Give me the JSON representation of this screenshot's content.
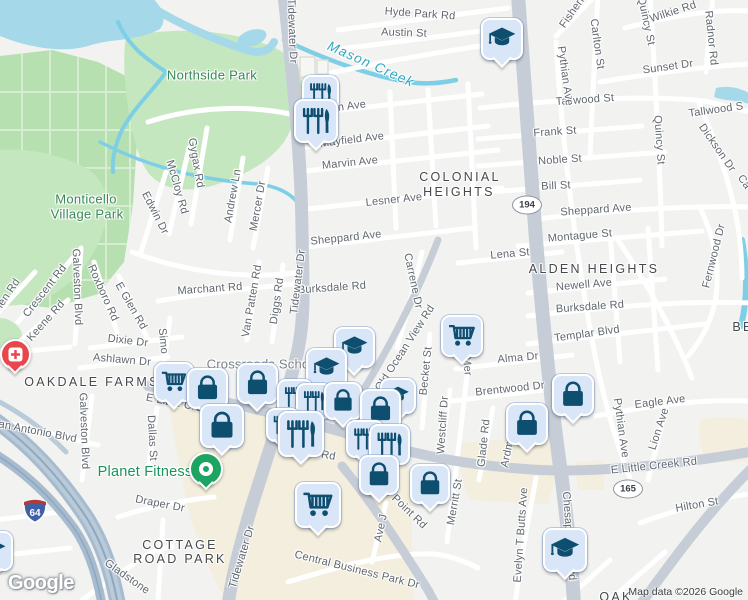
{
  "map": {
    "logo": "Google",
    "attribution": "Map data ©2026 Google",
    "colors": {
      "background": "#f2f2f0",
      "water": "#a5d9ea",
      "creek": "#7ecfe5",
      "park": "#c5e7c0",
      "cemetery": "#b7e0b0",
      "commercial": "#f3eedd",
      "major_road": "#c6cdd7",
      "highway": "#a6bbce",
      "minor_road": "#ffffff",
      "marker_fill": "#d9e6f8",
      "marker_icon": "#0e4e6f",
      "hospital_red": "#e9474b",
      "gym_green": "#1da462",
      "park_label": "#398758",
      "water_label": "#2ea6c0",
      "poi_green": "#18955c"
    },
    "shields": {
      "oval": [
        {
          "label": "194",
          "x": 527,
          "y": 205
        },
        {
          "label": "165",
          "x": 628,
          "y": 489
        }
      ],
      "interstate": {
        "label": "64"
      }
    },
    "labels": [
      {
        "text": "Hyde Park Rd",
        "x": 420,
        "y": 14,
        "rot": 4
      },
      {
        "text": "Austin St",
        "x": 404,
        "y": 33,
        "rot": 2
      },
      {
        "text": "Tidewater Dr",
        "x": 292,
        "y": 31,
        "rot": 88
      },
      {
        "text": "n Ave",
        "x": 352,
        "y": 106,
        "rot": -7
      },
      {
        "text": "Mayfield Ave",
        "x": 352,
        "y": 140,
        "rot": -7
      },
      {
        "text": "Marvin Ave",
        "x": 350,
        "y": 163,
        "rot": -6
      },
      {
        "text": "Lesner Ave",
        "x": 394,
        "y": 200,
        "rot": -6
      },
      {
        "text": "Sheppard Ave",
        "x": 346,
        "y": 238,
        "rot": -6
      },
      {
        "text": "Burksdale Rd",
        "x": 332,
        "y": 288,
        "rot": -4
      },
      {
        "text": "Marchant Rd",
        "x": 210,
        "y": 289,
        "rot": -4
      },
      {
        "text": "Gygax Rd",
        "x": 196,
        "y": 163,
        "rot": 80
      },
      {
        "text": "McCloy Rd",
        "x": 177,
        "y": 187,
        "rot": 74
      },
      {
        "text": "Edwin Dr",
        "x": 155,
        "y": 213,
        "rot": 63
      },
      {
        "text": "Andrew Ln",
        "x": 233,
        "y": 196,
        "rot": -80
      },
      {
        "text": "Mercer Dr",
        "x": 258,
        "y": 206,
        "rot": -80
      },
      {
        "text": "Crescent Rd",
        "x": 45,
        "y": 291,
        "rot": -52
      },
      {
        "text": "Galveston Blvd",
        "x": 77,
        "y": 287,
        "rot": 88
      },
      {
        "text": "Roxboro Rd",
        "x": 103,
        "y": 293,
        "rot": 66
      },
      {
        "text": "E Glen Rd",
        "x": 131,
        "y": 306,
        "rot": 60
      },
      {
        "text": "Keene Rd",
        "x": 46,
        "y": 321,
        "rot": -48
      },
      {
        "text": "Glen Rd",
        "x": 6,
        "y": 297,
        "rot": -56
      },
      {
        "text": "Dixie Dr",
        "x": 128,
        "y": 341,
        "rot": 7
      },
      {
        "text": "Ashlawn Dr",
        "x": 122,
        "y": 360,
        "rot": 5
      },
      {
        "text": "Simo",
        "x": 163,
        "y": 341,
        "rot": 85
      },
      {
        "text": "San Antonio Blvd",
        "x": 34,
        "y": 431,
        "rot": 11
      },
      {
        "text": "Galveston Blvd",
        "x": 84,
        "y": 431,
        "rot": 88
      },
      {
        "text": "Dallas St",
        "x": 152,
        "y": 438,
        "rot": 87
      },
      {
        "text": "E Little Cre",
        "x": 174,
        "y": 403,
        "rot": 11
      },
      {
        "text": "k Rd",
        "x": 324,
        "y": 455,
        "rot": 10
      },
      {
        "text": "Draper Dr",
        "x": 160,
        "y": 504,
        "rot": 11
      },
      {
        "text": "Gladstone",
        "x": 127,
        "y": 577,
        "rot": 35
      },
      {
        "text": "Tidewater Dr",
        "x": 298,
        "y": 282,
        "rot": -83
      },
      {
        "text": "Van Patten Rd",
        "x": 252,
        "y": 301,
        "rot": -80
      },
      {
        "text": "Diggs Rd",
        "x": 277,
        "y": 301,
        "rot": -82
      },
      {
        "text": "Tidewater Dr",
        "x": 242,
        "y": 557,
        "rot": -73
      },
      {
        "text": "Ave J",
        "x": 381,
        "y": 528,
        "rot": -78
      },
      {
        "text": "lls Point Rd",
        "x": 404,
        "y": 507,
        "rot": 44
      },
      {
        "text": "Central Business Park Dr",
        "x": 357,
        "y": 570,
        "rot": 14
      },
      {
        "text": "Westcliff Dr",
        "x": 443,
        "y": 425,
        "rot": -86
      },
      {
        "text": "Becket St",
        "x": 426,
        "y": 371,
        "rot": -84
      },
      {
        "text": "Mer",
        "x": 467,
        "y": 366,
        "rot": 85
      },
      {
        "text": "Glade Rd",
        "x": 484,
        "y": 443,
        "rot": -84
      },
      {
        "text": "Ardmo",
        "x": 508,
        "y": 451,
        "rot": -78
      },
      {
        "text": "Merritt St",
        "x": 455,
        "y": 502,
        "rot": -80
      },
      {
        "text": "Evelyn T Butts Ave",
        "x": 521,
        "y": 535,
        "rot": -86
      },
      {
        "text": "Chesapeake Blvd",
        "x": 569,
        "y": 536,
        "rot": 86
      },
      {
        "text": "Carrene Dr",
        "x": 413,
        "y": 281,
        "rot": 78
      },
      {
        "text": "Old Ocean View Rd",
        "x": 405,
        "y": 348,
        "rot": -57
      },
      {
        "text": "Lena St",
        "x": 510,
        "y": 254,
        "rot": -5
      },
      {
        "text": "Sheppard Ave",
        "x": 596,
        "y": 210,
        "rot": -4
      },
      {
        "text": "Montague St",
        "x": 580,
        "y": 236,
        "rot": -5
      },
      {
        "text": "Newell Ave",
        "x": 584,
        "y": 285,
        "rot": -5
      },
      {
        "text": "Burksdale Rd",
        "x": 590,
        "y": 307,
        "rot": -4
      },
      {
        "text": "Templar Blvd",
        "x": 587,
        "y": 334,
        "rot": -8
      },
      {
        "text": "Alma Dr",
        "x": 518,
        "y": 358,
        "rot": -5
      },
      {
        "text": "Brentwood Dr",
        "x": 510,
        "y": 389,
        "rot": -6
      },
      {
        "text": "Eagle Ave",
        "x": 660,
        "y": 402,
        "rot": -7
      },
      {
        "text": "E Little Creek Rd",
        "x": 654,
        "y": 466,
        "rot": -6
      },
      {
        "text": "Hilton St",
        "x": 697,
        "y": 505,
        "rot": -10
      },
      {
        "text": "Pythian Ave",
        "x": 621,
        "y": 428,
        "rot": 82
      },
      {
        "text": "Lion Ave",
        "x": 659,
        "y": 429,
        "rot": -72
      },
      {
        "text": "Tallwood St",
        "x": 585,
        "y": 100,
        "rot": -4
      },
      {
        "text": "Tallwood S",
        "x": 716,
        "y": 110,
        "rot": -8
      },
      {
        "text": "Frank St",
        "x": 555,
        "y": 132,
        "rot": -4
      },
      {
        "text": "Noble St",
        "x": 560,
        "y": 160,
        "rot": -4
      },
      {
        "text": "Bill St",
        "x": 556,
        "y": 186,
        "rot": -3
      },
      {
        "text": "Sunset Dr",
        "x": 668,
        "y": 67,
        "rot": -8
      },
      {
        "text": "Wilkie Rd",
        "x": 673,
        "y": 12,
        "rot": -18
      },
      {
        "text": "Fisherm",
        "x": 574,
        "y": 10,
        "rot": -55
      },
      {
        "text": "Carlton St",
        "x": 597,
        "y": 44,
        "rot": 82
      },
      {
        "text": "Pythian Ave",
        "x": 565,
        "y": 76,
        "rot": 82
      },
      {
        "text": "Quincy St",
        "x": 646,
        "y": 21,
        "rot": 78
      },
      {
        "text": "Radnor Rd",
        "x": 711,
        "y": 38,
        "rot": 84
      },
      {
        "text": "Quincy St",
        "x": 659,
        "y": 140,
        "rot": 86
      },
      {
        "text": "Dickson Dr",
        "x": 717,
        "y": 148,
        "rot": 55
      },
      {
        "text": "Fernwood Dr",
        "x": 714,
        "y": 256,
        "rot": -76
      },
      {
        "text": "Ca",
        "x": 744,
        "y": 182,
        "rot": 55
      },
      {
        "text": "COLONIAL",
        "x": 460,
        "y": 177,
        "rot": 0,
        "cls": "area"
      },
      {
        "text": "HEIGHTS",
        "x": 459,
        "y": 192,
        "rot": 0,
        "cls": "area"
      },
      {
        "text": "ALDEN HEIGHTS",
        "x": 594,
        "y": 269,
        "rot": 0,
        "cls": "area"
      },
      {
        "text": "OAKDALE FARMS",
        "x": 92,
        "y": 382,
        "rot": 0,
        "cls": "area"
      },
      {
        "text": "COTTAGE",
        "x": 180,
        "y": 545,
        "rot": 0,
        "cls": "area"
      },
      {
        "text": "ROAD PARK",
        "x": 180,
        "y": 559,
        "rot": 0,
        "cls": "area"
      },
      {
        "text": "OAK",
        "x": 616,
        "y": 597,
        "rot": 0,
        "cls": "area"
      },
      {
        "text": "BE",
        "x": 743,
        "y": 327,
        "rot": 0,
        "cls": "area"
      },
      {
        "text": "Northside Park",
        "x": 212,
        "y": 75,
        "rot": 0,
        "cls": "park"
      },
      {
        "text": "Monticello",
        "x": 86,
        "y": 199,
        "rot": 0,
        "cls": "park"
      },
      {
        "text": "Village Park",
        "x": 87,
        "y": 214,
        "rot": 0,
        "cls": "park"
      },
      {
        "text": "Mason Creek",
        "x": 371,
        "y": 64,
        "rot": 24,
        "cls": "water"
      },
      {
        "text": "Crossroads Scho",
        "x": 258,
        "y": 364,
        "rot": 0,
        "cls": "poi-gray"
      },
      {
        "text": "Planet Fitness",
        "x": 145,
        "y": 472,
        "rot": 0,
        "cls": "poi-green"
      }
    ],
    "markers": [
      {
        "type": "restaurant",
        "x": 318,
        "y": 91,
        "s": 33
      },
      {
        "type": "restaurant",
        "x": 314,
        "y": 119,
        "s": 40
      },
      {
        "type": "school",
        "x": 500,
        "y": 37,
        "s": 38
      },
      {
        "type": "school",
        "x": 352,
        "y": 345,
        "s": 37
      },
      {
        "type": "school",
        "x": 324,
        "y": 366,
        "s": 37
      },
      {
        "type": "cart",
        "x": 172,
        "y": 380,
        "s": 36
      },
      {
        "type": "bag",
        "x": 205,
        "y": 386,
        "s": 37
      },
      {
        "type": "bag",
        "x": 255,
        "y": 381,
        "s": 37
      },
      {
        "type": "restaurant",
        "x": 293,
        "y": 395,
        "s": 32
      },
      {
        "type": "restaurant",
        "x": 312,
        "y": 399,
        "s": 32
      },
      {
        "type": "bag",
        "x": 341,
        "y": 399,
        "s": 34
      },
      {
        "type": "school",
        "x": 396,
        "y": 394,
        "s": 32
      },
      {
        "type": "bag",
        "x": 378,
        "y": 407,
        "s": 37
      },
      {
        "type": "bag",
        "x": 220,
        "y": 424,
        "s": 40
      },
      {
        "type": "restaurant",
        "x": 281,
        "y": 423,
        "s": 30
      },
      {
        "type": "restaurant",
        "x": 299,
        "y": 432,
        "s": 42
      },
      {
        "type": "restaurant",
        "x": 363,
        "y": 437,
        "s": 34
      },
      {
        "type": "restaurant",
        "x": 387,
        "y": 442,
        "s": 37
      },
      {
        "type": "bag",
        "x": 377,
        "y": 473,
        "s": 36
      },
      {
        "type": "cart",
        "x": 460,
        "y": 334,
        "s": 38
      },
      {
        "type": "bag",
        "x": 525,
        "y": 422,
        "s": 38
      },
      {
        "type": "bag",
        "x": 571,
        "y": 393,
        "s": 38
      },
      {
        "type": "bag",
        "x": 428,
        "y": 482,
        "s": 36
      },
      {
        "type": "cart",
        "x": 316,
        "y": 503,
        "s": 42
      },
      {
        "type": "school",
        "x": 563,
        "y": 548,
        "s": 40
      },
      {
        "type": "school",
        "x": -9,
        "y": 549,
        "s": 36
      },
      {
        "type": "hospital",
        "x": 13,
        "y": 352,
        "s": 27
      },
      {
        "type": "gym",
        "x": 204,
        "y": 467,
        "s": 30
      }
    ]
  }
}
